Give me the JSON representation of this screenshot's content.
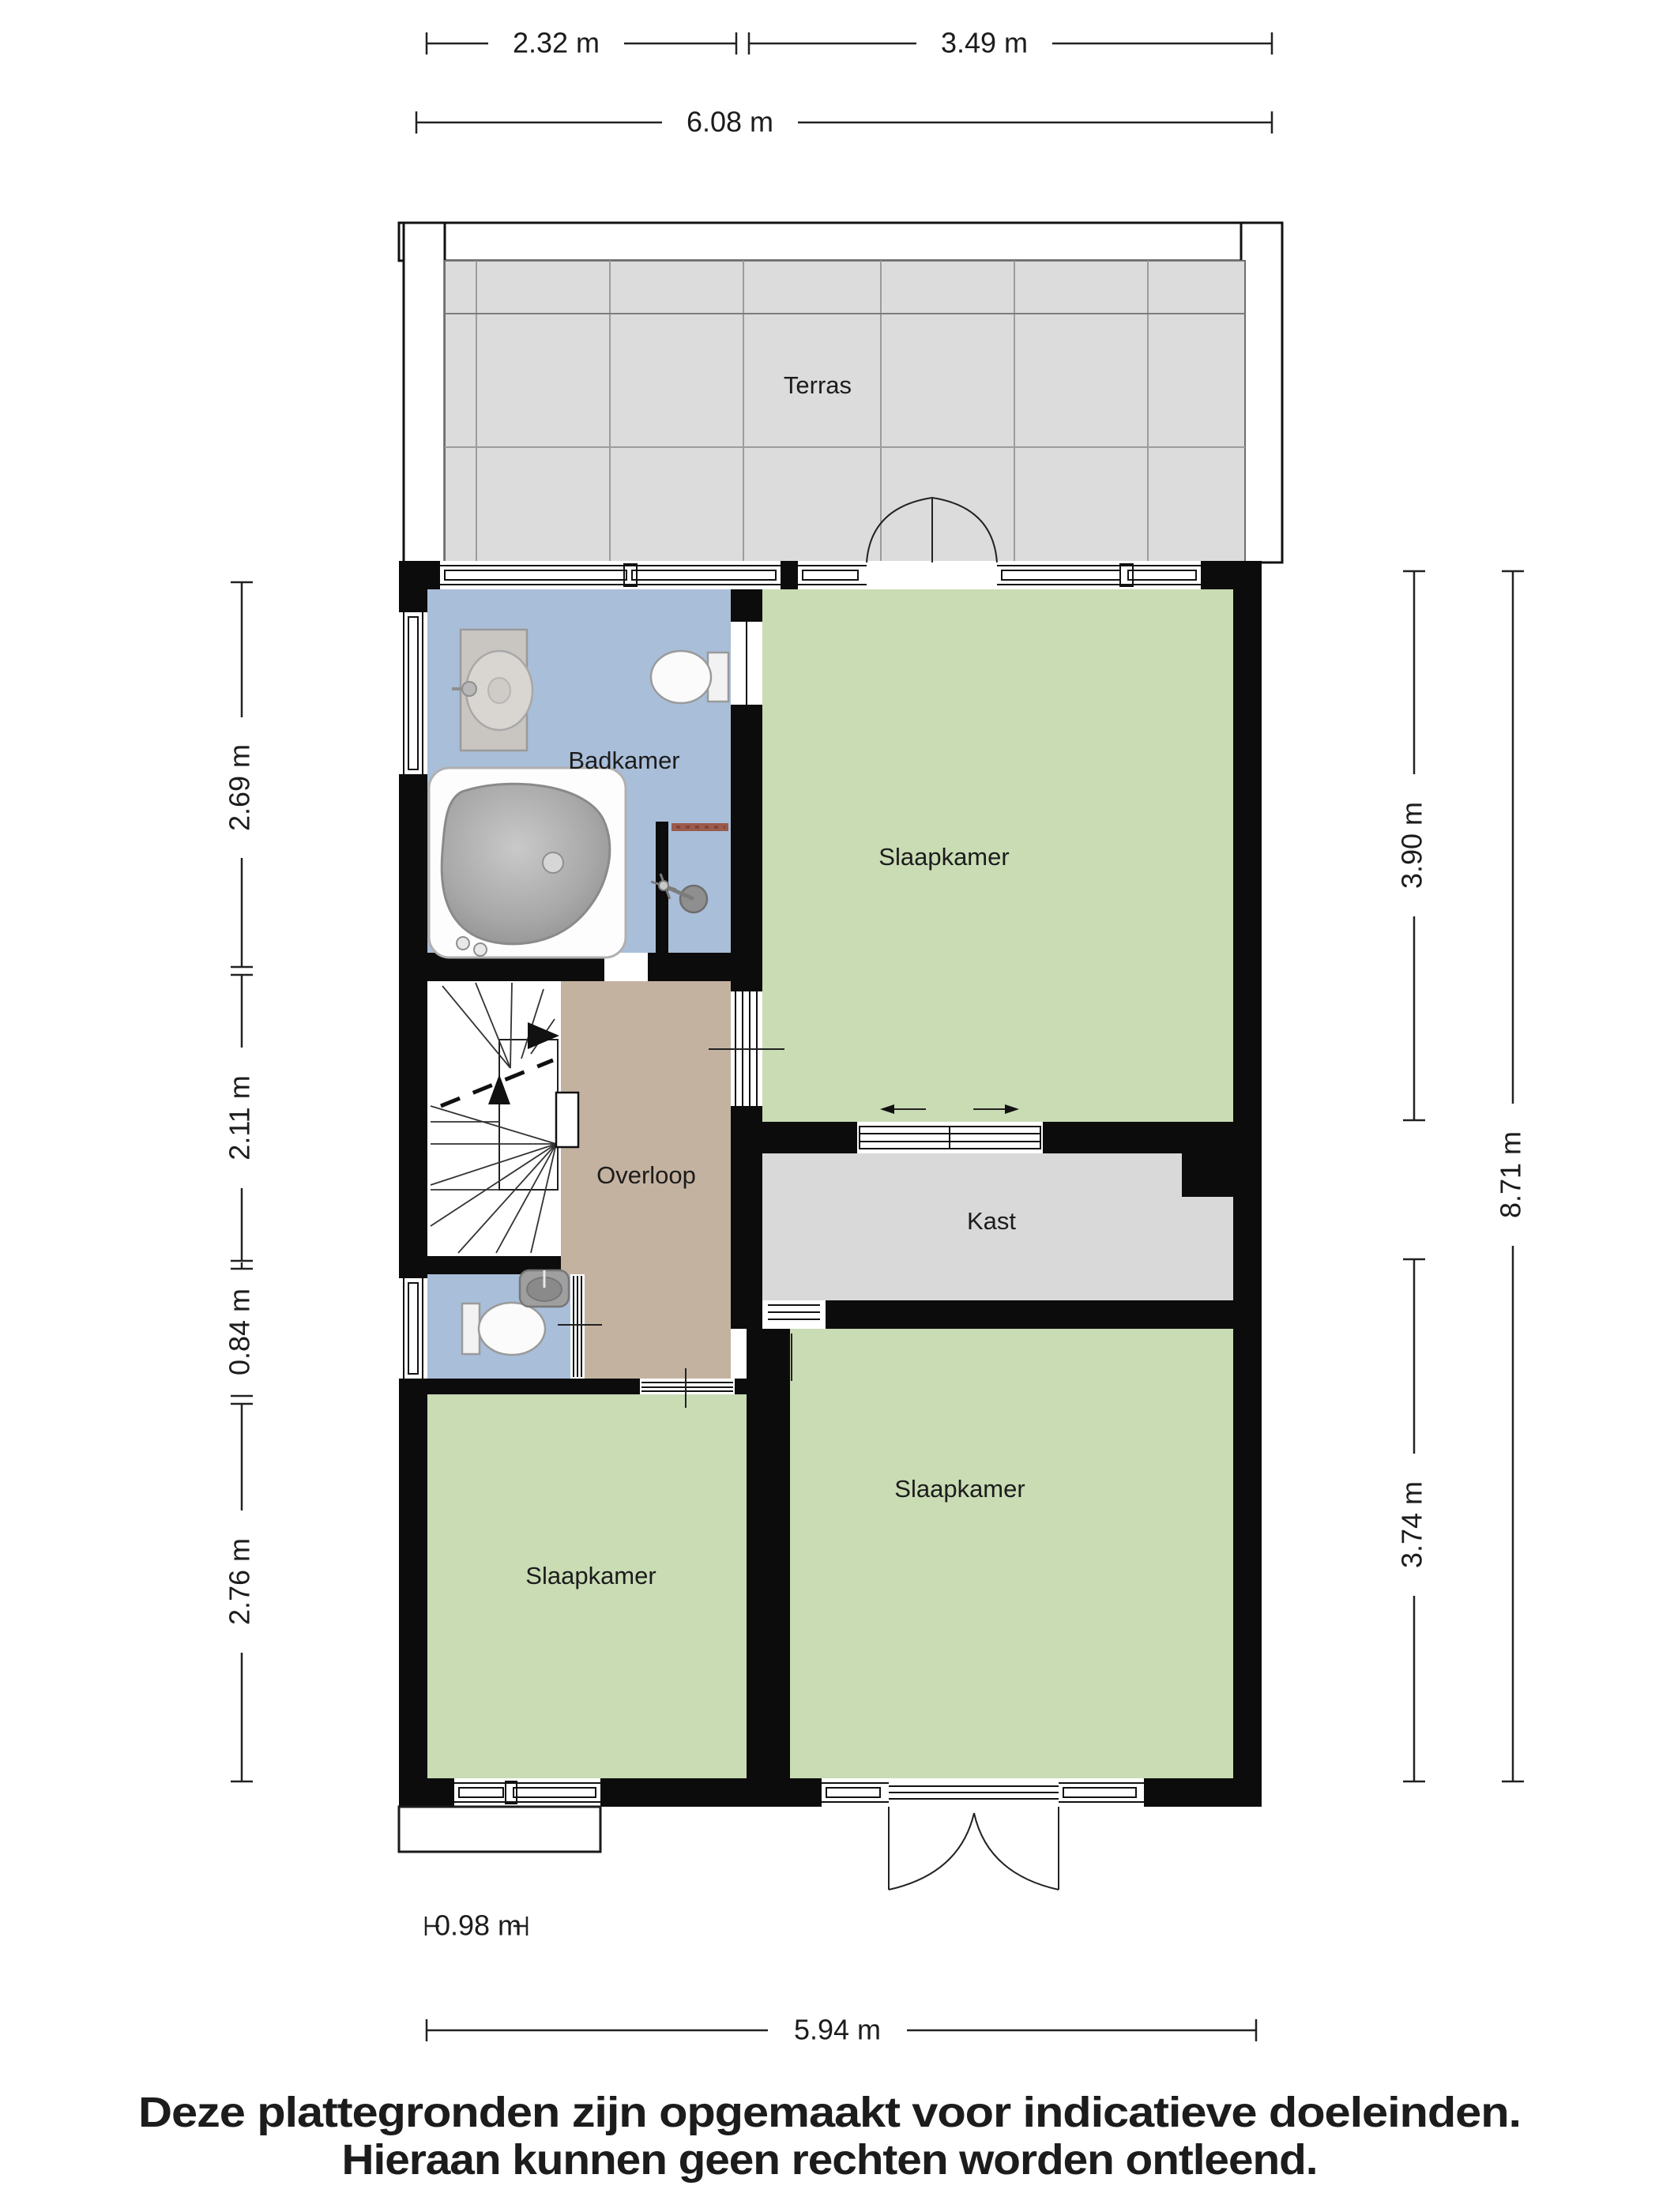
{
  "rooms": {
    "terras": "Terras",
    "badkamer": "Badkamer",
    "slaapkamer_top": "Slaapkamer",
    "overloop": "Overloop",
    "kast": "Kast",
    "slaapkamer_left": "Slaapkamer",
    "slaapkamer_right": "Slaapkamer"
  },
  "dimensions": {
    "top": [
      {
        "label": "2.32 m"
      },
      {
        "label": "3.49 m"
      },
      {
        "label": "6.08 m"
      }
    ],
    "left": [
      {
        "label": "2.69 m"
      },
      {
        "label": "2.11 m"
      },
      {
        "label": "0.84 m"
      },
      {
        "label": "2.76 m"
      }
    ],
    "right": [
      {
        "label": "3.90 m"
      },
      {
        "label": "8.71 m"
      },
      {
        "label": "3.74 m"
      }
    ],
    "bottom": [
      {
        "label": "0.98 m"
      },
      {
        "label": "5.94 m"
      }
    ]
  },
  "disclaimer": {
    "line1": "Deze plattegronden zijn opgemaakt voor indicatieve doeleinden.",
    "line2": "Hieraan kunnen geen rechten worden ontleend."
  },
  "colors": {
    "wall": "#0c0c0c",
    "room_green": "#c9dcb4",
    "room_blue": "#a9bed9",
    "room_tan": "#c4b2a0",
    "room_gray": "#d9d9d9",
    "terrace_tile": "#dcdcdc",
    "terrace_grid": "#9c9c9c",
    "shelf_accent": "#9b5a4c"
  }
}
